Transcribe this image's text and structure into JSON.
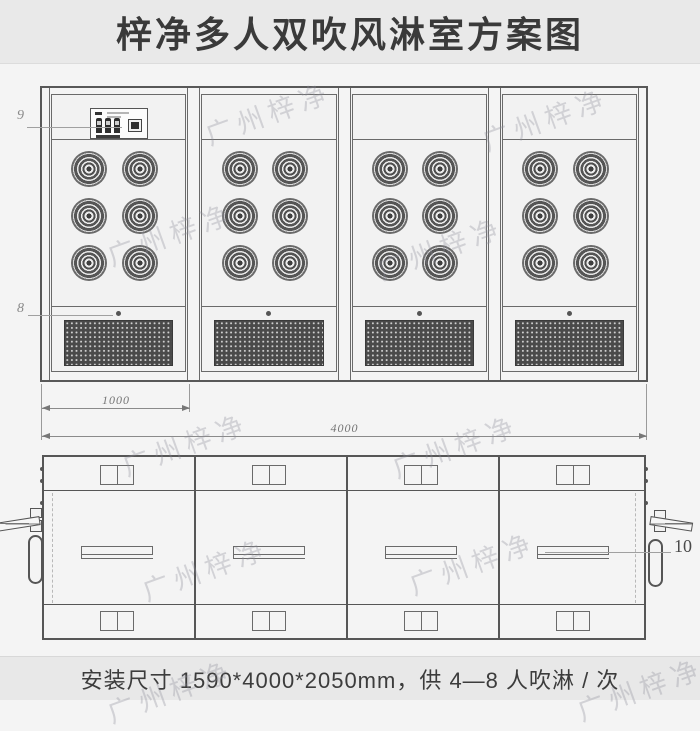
{
  "title": "梓净多人双吹风淋室方案图",
  "watermark": {
    "text": "广州梓净"
  },
  "front_view": {
    "callout_control_panel": "9",
    "callout_grille": "8",
    "dim_module_width": "1000",
    "dim_total_width": "4000"
  },
  "plan_view": {
    "callout_door": "10"
  },
  "footer": {
    "text": "安装尺寸 1590*4000*2050mm，供 4—8 人吹淋 / 次"
  }
}
